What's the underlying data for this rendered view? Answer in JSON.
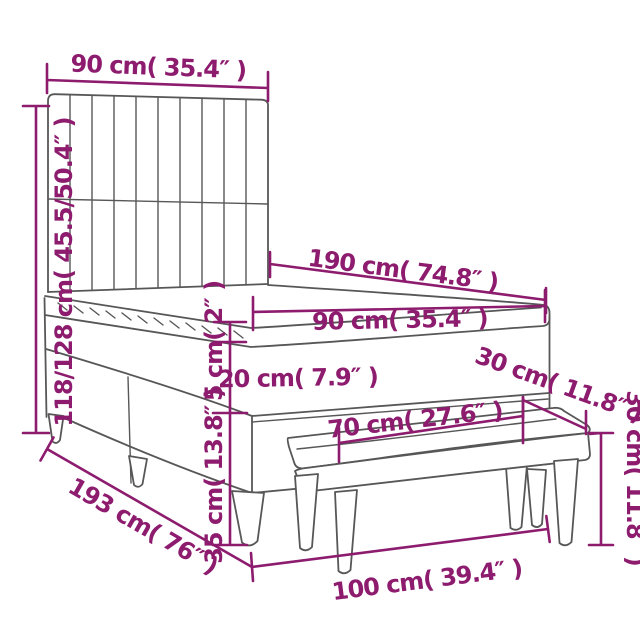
{
  "diagram": {
    "title": "bed-with-headboard-and-bench-dimension-diagram",
    "background_color": "#FFFFFF",
    "drawing_line_color": "#575757",
    "dimension_color": "#8D1B6E",
    "dimensions": [
      {
        "id": "headboard-width",
        "label": "90 cm( 35.4″ )"
      },
      {
        "id": "headboard-height",
        "label": "118/128 cm( 45.5/50.4″ )"
      },
      {
        "id": "bed-length",
        "label": "190 cm( 74.8″ )"
      },
      {
        "id": "mattress-width",
        "label": "90 cm( 35.4″ )"
      },
      {
        "id": "topper-thickness",
        "label": "5 cm( 2″ )"
      },
      {
        "id": "mattress-thickness",
        "label": "20 cm( 7.9″ )"
      },
      {
        "id": "bench-depth",
        "label": "30 cm( 11.8″ )"
      },
      {
        "id": "bench-seat-length",
        "label": "70 cm( 27.6″ )"
      },
      {
        "id": "bench-height",
        "label": "30 cm( 11.8″ )"
      },
      {
        "id": "base-height",
        "label": "35 cm( 13.8″ )"
      },
      {
        "id": "bed-total-length",
        "label": "193 cm( 76″ )"
      },
      {
        "id": "bed-total-width",
        "label": "100 cm( 39.4″ )"
      }
    ]
  }
}
